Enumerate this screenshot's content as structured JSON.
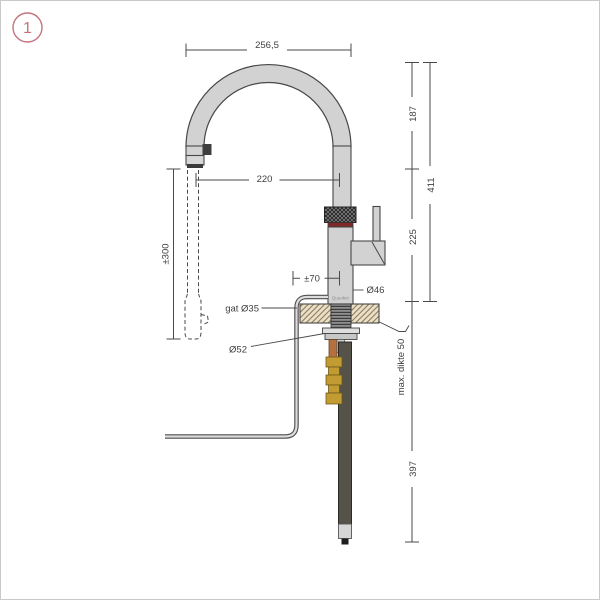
{
  "page": {
    "badge": "1"
  },
  "labels": {
    "arc_width": "256,5",
    "reach": "220",
    "hose_extension": "±300",
    "height_upper": "187",
    "height_total": "411",
    "height_lower": "225",
    "base_offset": "±70",
    "body_diameter": "Ø46",
    "hole_label": "gat Ø35",
    "nut_diameter": "Ø52",
    "counter_thickness": "max. dikte 50",
    "under_counter_length": "397",
    "brand": "Quooker"
  },
  "colors": {
    "badge_accent": "#c4737c",
    "line": "#4a4a4a",
    "metal": "#d2d2d2",
    "knurl": "#2f2f2f",
    "red_band": "#802828",
    "countertop": "#eadfc6",
    "brass": "#c39b33",
    "copper": "#b4703f",
    "dark_tube": "#55524a"
  }
}
